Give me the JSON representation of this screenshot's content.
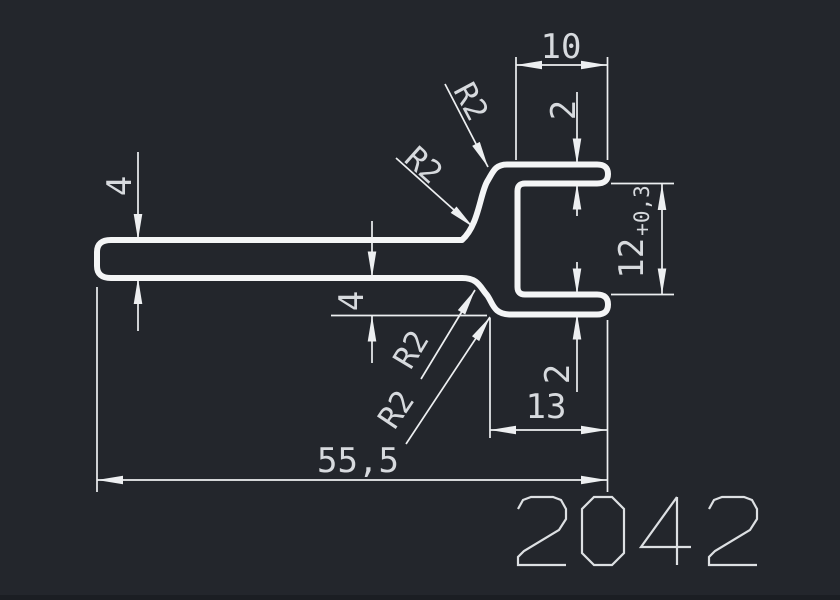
{
  "drawing": {
    "colors": {
      "background": "#23262c",
      "line_color": "#f4f5f6",
      "dim_color": "#edeff1",
      "text_color": "#d7dade"
    },
    "dims": {
      "top_width": "10",
      "top_thickness": "2",
      "inner_height": "12",
      "inner_height_tol": "+0,3",
      "wall_left": "4",
      "wall_mid": "4",
      "bottom_thickness": "2",
      "bottom_width": "13",
      "overall_length": "55,5",
      "r_top_outer": "R2",
      "r_top_inner": "R2",
      "r_bottom_inner": "R2",
      "r_bottom_outer": "R2"
    },
    "part_number": "2042"
  }
}
